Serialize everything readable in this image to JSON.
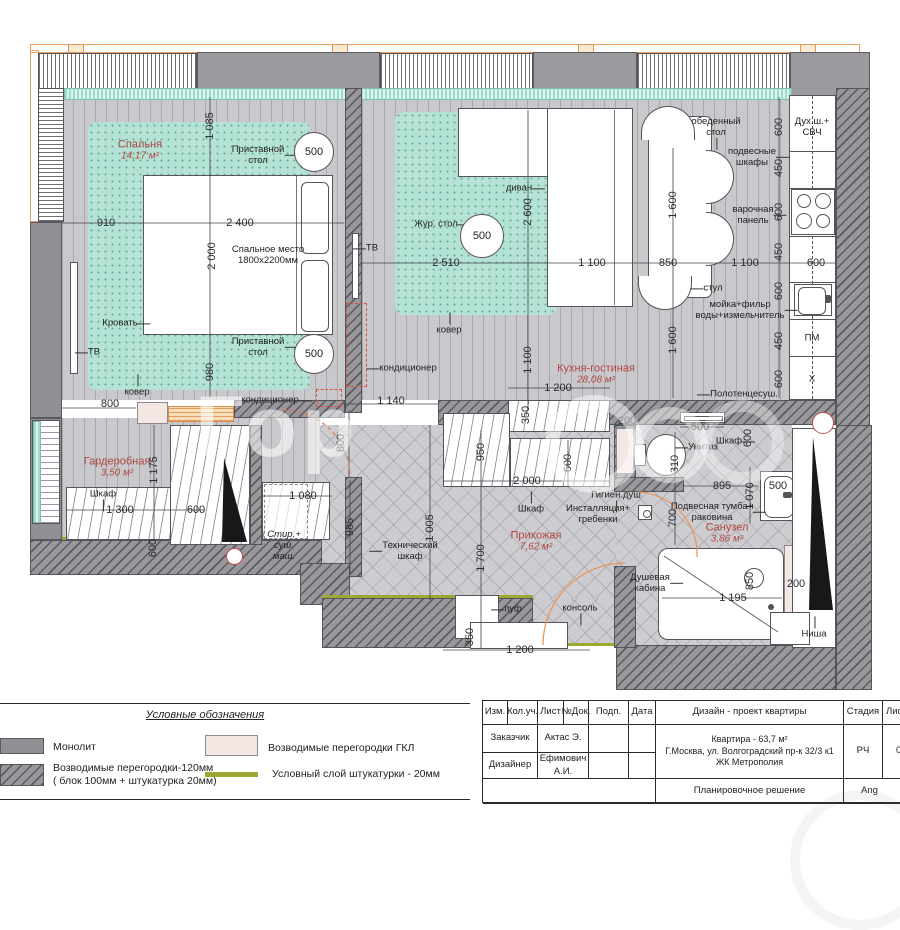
{
  "watermark_text": "Гор",
  "plan": {
    "rooms": [
      {
        "n": "Спальня",
        "a": "14,17 м²",
        "x": 140,
        "y": 150
      },
      {
        "n": "Кухня-гостиная",
        "a": "28,08 м²",
        "x": 596,
        "y": 374
      },
      {
        "n": "Гардеробная",
        "a": "3,50 м²",
        "x": 117,
        "y": 467
      },
      {
        "n": "Прихожая",
        "a": "7,62 м²",
        "x": 536,
        "y": 541
      },
      {
        "n": "Санузел",
        "a": "3,86 м²",
        "x": 727,
        "y": 533
      }
    ],
    "dims": [
      {
        "t": "1 085",
        "x": 210,
        "y": 126,
        "v": 1
      },
      {
        "t": "910",
        "x": 106,
        "y": 223
      },
      {
        "t": "2 400",
        "x": 240,
        "y": 223
      },
      {
        "t": "2 000",
        "x": 212,
        "y": 256,
        "v": 1
      },
      {
        "t": "980",
        "x": 210,
        "y": 372,
        "v": 1
      },
      {
        "t": "800",
        "x": 110,
        "y": 404
      },
      {
        "t": "800",
        "x": 341,
        "y": 443,
        "v": 1
      },
      {
        "t": "1 140",
        "x": 391,
        "y": 401
      },
      {
        "t": "2 510",
        "x": 446,
        "y": 263
      },
      {
        "t": "1 100",
        "x": 592,
        "y": 263
      },
      {
        "t": "2 600",
        "x": 528,
        "y": 212,
        "v": 1
      },
      {
        "t": "1 100",
        "x": 528,
        "y": 360,
        "v": 1
      },
      {
        "t": "1 600",
        "x": 673,
        "y": 205,
        "v": 1
      },
      {
        "t": "850",
        "x": 668,
        "y": 263
      },
      {
        "t": "1 100",
        "x": 745,
        "y": 263
      },
      {
        "t": "600",
        "x": 816,
        "y": 263
      },
      {
        "t": "600",
        "x": 779,
        "y": 127,
        "v": 1
      },
      {
        "t": "450",
        "x": 779,
        "y": 168,
        "v": 1
      },
      {
        "t": "600",
        "x": 779,
        "y": 212,
        "v": 1
      },
      {
        "t": "450",
        "x": 779,
        "y": 252,
        "v": 1
      },
      {
        "t": "600",
        "x": 779,
        "y": 291,
        "v": 1
      },
      {
        "t": "450",
        "x": 779,
        "y": 341,
        "v": 1
      },
      {
        "t": "600",
        "x": 779,
        "y": 379,
        "v": 1
      },
      {
        "t": "1 600",
        "x": 673,
        "y": 340,
        "v": 1
      },
      {
        "t": "1 175",
        "x": 154,
        "y": 470,
        "v": 1
      },
      {
        "t": "1 300",
        "x": 120,
        "y": 510
      },
      {
        "t": "600",
        "x": 153,
        "y": 548,
        "v": 1
      },
      {
        "t": "600",
        "x": 196,
        "y": 510
      },
      {
        "t": "1 080",
        "x": 303,
        "y": 496
      },
      {
        "t": "985",
        "x": 350,
        "y": 527,
        "v": 1
      },
      {
        "t": "1 005",
        "x": 430,
        "y": 528,
        "v": 1
      },
      {
        "t": "1 700",
        "x": 481,
        "y": 558,
        "v": 1
      },
      {
        "t": "950",
        "x": 481,
        "y": 452,
        "v": 1
      },
      {
        "t": "600",
        "x": 568,
        "y": 463,
        "v": 1
      },
      {
        "t": "2 000",
        "x": 527,
        "y": 481
      },
      {
        "t": "350",
        "x": 526,
        "y": 415,
        "v": 1
      },
      {
        "t": "1 200",
        "x": 558,
        "y": 388
      },
      {
        "t": "350",
        "x": 470,
        "y": 637,
        "v": 1
      },
      {
        "t": "1 200",
        "x": 520,
        "y": 650
      },
      {
        "t": "200",
        "x": 627,
        "y": 421
      },
      {
        "t": "500",
        "x": 700,
        "y": 427
      },
      {
        "t": "310",
        "x": 675,
        "y": 464,
        "v": 1
      },
      {
        "t": "895",
        "x": 722,
        "y": 486
      },
      {
        "t": "1 070",
        "x": 750,
        "y": 496,
        "v": 1
      },
      {
        "t": "500",
        "x": 778,
        "y": 486
      },
      {
        "t": "700",
        "x": 673,
        "y": 518,
        "v": 1
      },
      {
        "t": "1 195",
        "x": 733,
        "y": 598
      },
      {
        "t": "850",
        "x": 750,
        "y": 581,
        "v": 1
      },
      {
        "t": "200",
        "x": 796,
        "y": 584
      },
      {
        "t": "600",
        "x": 748,
        "y": 438,
        "v": 1
      }
    ],
    "labels": [
      {
        "t": "Приставной\nстол",
        "x": 258,
        "y": 155,
        "a": "r"
      },
      {
        "t": "Приставной\nстол",
        "x": 258,
        "y": 347,
        "a": "r"
      },
      {
        "t": "Кровать",
        "x": 120,
        "y": 323,
        "a": "r"
      },
      {
        "t": "Спальное место\n1800х2200мм",
        "x": 268,
        "y": 255
      },
      {
        "t": "ТВ",
        "x": 94,
        "y": 352,
        "a": "l"
      },
      {
        "t": "ТВ",
        "x": 372,
        "y": 248,
        "a": "l"
      },
      {
        "t": "ковер",
        "x": 137,
        "y": 392,
        "a": "u"
      },
      {
        "t": "ковер",
        "x": 449,
        "y": 330,
        "a": "u"
      },
      {
        "t": "кондиционер",
        "x": 408,
        "y": 368,
        "a": "l"
      },
      {
        "t": "кондиционер",
        "x": 270,
        "y": 400,
        "a": "r"
      },
      {
        "t": "диван",
        "x": 519,
        "y": 188,
        "a": "r"
      },
      {
        "t": "Жур. стол",
        "x": 436,
        "y": 224,
        "a": "r"
      },
      {
        "t": "обеденный\nстол",
        "x": 716,
        "y": 127,
        "a": "d"
      },
      {
        "t": "подвесные\nшкафы",
        "x": 752,
        "y": 157,
        "a": "r"
      },
      {
        "t": "варочная\nпанель",
        "x": 753,
        "y": 215,
        "a": "r"
      },
      {
        "t": "стул",
        "x": 713,
        "y": 288,
        "a": "l"
      },
      {
        "t": "мойка+фильр\nводы+измельчитель",
        "x": 740,
        "y": 310,
        "a": "r"
      },
      {
        "t": "Дух.ш.+\nСВЧ",
        "x": 812,
        "y": 127
      },
      {
        "t": "ПМ",
        "x": 812,
        "y": 338
      },
      {
        "t": "Х",
        "x": 812,
        "y": 379
      },
      {
        "t": "Полотенцесуш.",
        "x": 744,
        "y": 394,
        "a": "l"
      },
      {
        "t": "Шкаф",
        "x": 103,
        "y": 494,
        "a": "d"
      },
      {
        "t": "Стир.+\nсуш.\nмаш.",
        "x": 284,
        "y": 546,
        "it": 1
      },
      {
        "t": "Технический\nшкаф",
        "x": 410,
        "y": 551,
        "a": "l"
      },
      {
        "t": "Шкаф",
        "x": 531,
        "y": 509,
        "a": "u"
      },
      {
        "t": "Инсталляция+\nгребенки",
        "x": 598,
        "y": 514
      },
      {
        "t": "Гигиен.душ",
        "x": 616,
        "y": 495,
        "a": "d"
      },
      {
        "t": "пуф",
        "x": 513,
        "y": 609,
        "a": "l"
      },
      {
        "t": "консоль",
        "x": 580,
        "y": 608,
        "a": "d"
      },
      {
        "t": "Унитаз",
        "x": 703,
        "y": 447,
        "a": "l"
      },
      {
        "t": "Шкаф",
        "x": 729,
        "y": 441,
        "a": "r"
      },
      {
        "t": "Подвесная тумба+\nраковина",
        "x": 712,
        "y": 512,
        "a": "r"
      },
      {
        "t": "Душевая\nкабина",
        "x": 650,
        "y": 583,
        "a": "r"
      },
      {
        "t": "Ниша",
        "x": 814,
        "y": 634,
        "a": "u"
      }
    ],
    "circles": [
      {
        "t": "500",
        "x": 314,
        "y": 152,
        "r": 20
      },
      {
        "t": "500",
        "x": 314,
        "y": 354,
        "r": 20
      },
      {
        "t": "500",
        "x": 482,
        "y": 236,
        "r": 22
      }
    ]
  },
  "legend": {
    "title": "Условные обозначения",
    "items": [
      {
        "label": "Монолит"
      },
      {
        "label": "Возводимые перегородки-120мм\n( блок 100мм + штукатурка 20мм)"
      },
      {
        "label": "Возводимые перегородки ГКЛ"
      },
      {
        "label": "Условный слой штукатурки - 20мм"
      }
    ]
  },
  "titleblock": {
    "headers": [
      "Изм.",
      "Кол.уч.",
      "Лист",
      "№Док.",
      "Подп.",
      "Дата"
    ],
    "project": "Дизайн - проект квартиры",
    "stage_label": "Стадия",
    "sheet_label": "Лист",
    "customer_label": "Заказчик",
    "customer": "Актас Э.",
    "designer_label": "Дизайнер",
    "designer": "Ефимович А.И.",
    "address1": "Квартира - 63,7 м²",
    "address2": "Г.Москва, ул. Волгоградский пр-к 32/3 к1",
    "address3": "ЖК Метрополия",
    "stage": "РЧ",
    "sheet_partial": "0",
    "doc_title": "Планировочное решение",
    "org_partial": "Ang"
  }
}
